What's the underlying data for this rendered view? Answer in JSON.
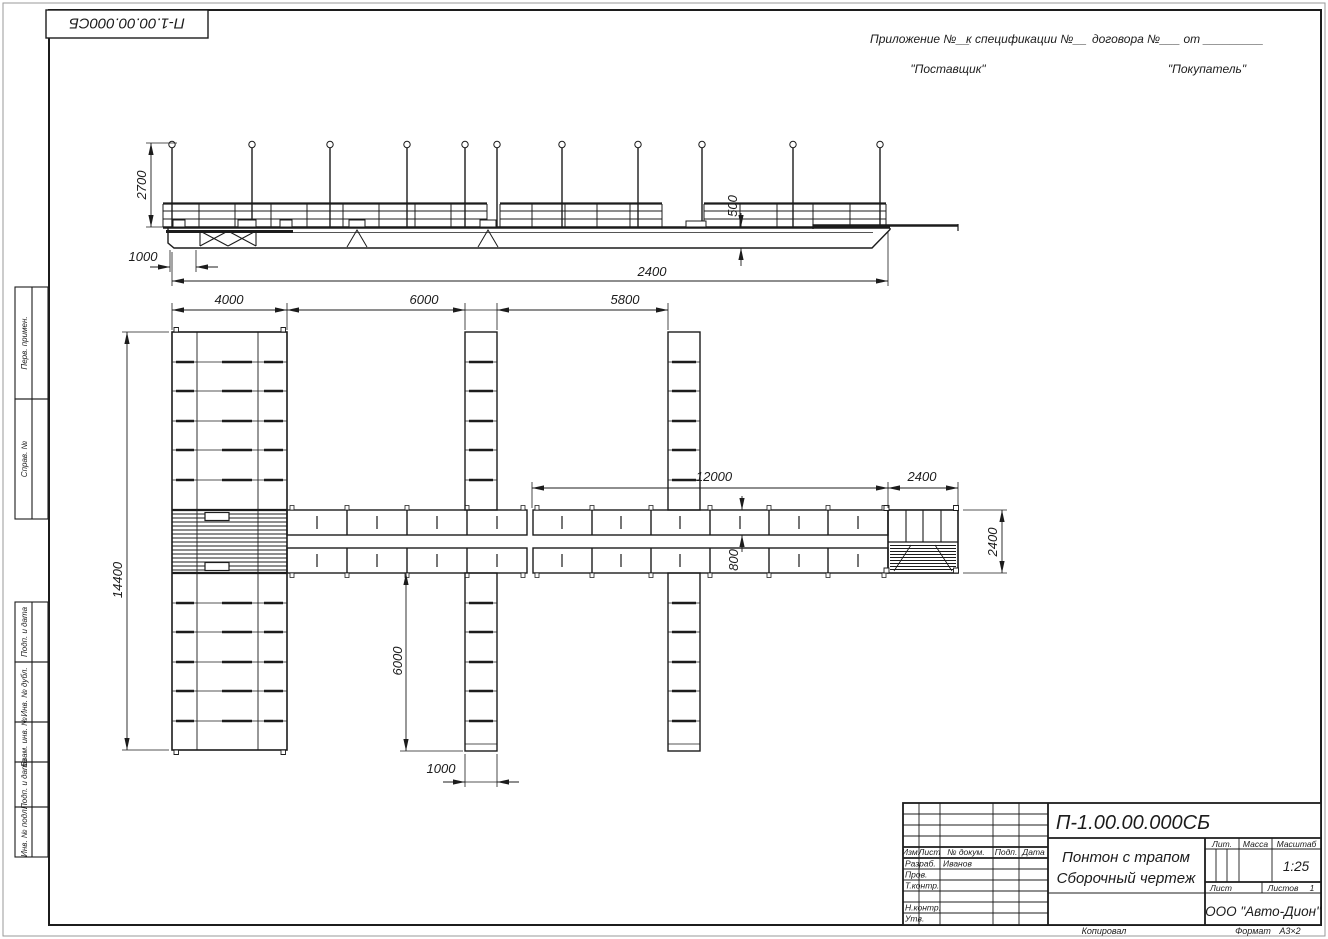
{
  "sheet": {
    "corner_stamp": "П-1.00.00.000СБ",
    "header": {
      "part1": "Приложение №__",
      "part2": "к спецификации №__",
      "part3": "договора №___  от _________",
      "supplier": "\"Поставщик\"",
      "buyer": "\"Покупатель\""
    },
    "margin_labels": [
      "Перв. примен.",
      "Справ. №",
      "Подп. и дата",
      "Инв. № дубл.",
      "Взам. инв. №",
      "Подп. и дата",
      "Инв. № подл."
    ],
    "footer": {
      "kopiroval": "Копировал",
      "format_label": "Формат",
      "format_value": "А3×2"
    }
  },
  "drawing": {
    "elevation_dims": {
      "post_height": "2700",
      "ramp_offset": "1000",
      "overall": "2400",
      "hull_depth": "500"
    },
    "plan_dims": {
      "block_width": "4000",
      "bay_left": "6000",
      "bay_right": "5800",
      "walkway_length": "12000",
      "platform_width": "2400",
      "platform_depth": "2400",
      "block_length": "14400",
      "walkway_width": "800",
      "finger_length": "6000",
      "finger_width": "1000"
    }
  },
  "title_block": {
    "doc_number": "П-1.00.00.000СБ",
    "name_line1": "Понтон с трапом",
    "name_line2": "Сборочный чертеж",
    "company": "ООО \"Авто-Дион\"",
    "scale_value": "1:25",
    "sheets_value": "1",
    "developer_name": "Иванов",
    "labels": {
      "izm": "Изм.",
      "list": "Лист",
      "ndoc": "№ докум.",
      "podp": "Подп.",
      "data": "Дата",
      "razrab": "Разраб.",
      "prov": "Пров.",
      "tkontr": "Т.контр.",
      "nkontr": "Н.контр.",
      "utv": "Утв.",
      "lit": "Лит.",
      "massa": "Масса",
      "masshtab": "Масштаб",
      "list2": "Лист",
      "listov": "Листов"
    }
  }
}
